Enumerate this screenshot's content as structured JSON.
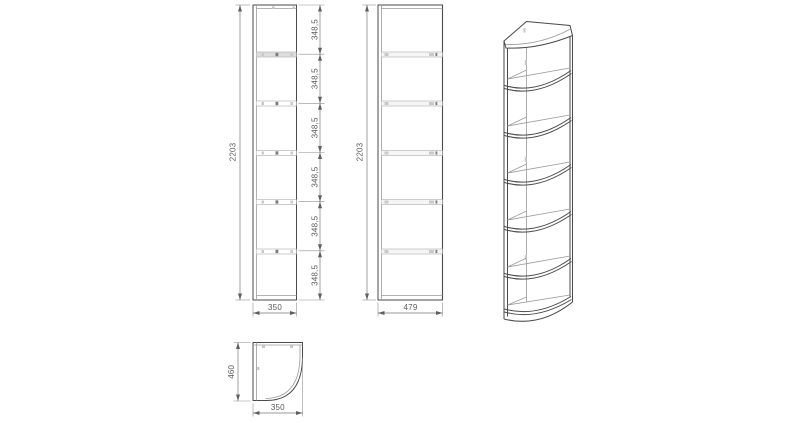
{
  "drawing": {
    "type": "furniture-technical-drawing",
    "subject": "corner open shelf unit, three orthographic views and one isometric view",
    "front_view": {
      "overall_height": "2203",
      "overall_width": "350",
      "shelf_spacings": [
        "348,5",
        "348,5",
        "348,5",
        "348,5",
        "348,5",
        "348,5"
      ]
    },
    "side_view": {
      "overall_height": "2203",
      "overall_depth": "479"
    },
    "plan_view": {
      "depth": "460",
      "width": "350"
    },
    "colors": {
      "line": "#4a4a4a",
      "line_light": "#bdbdbd",
      "dimension": "#787878",
      "text": "#5a5a5a",
      "shelf_fill": "#dcdcdc",
      "background": "#ffffff"
    }
  }
}
